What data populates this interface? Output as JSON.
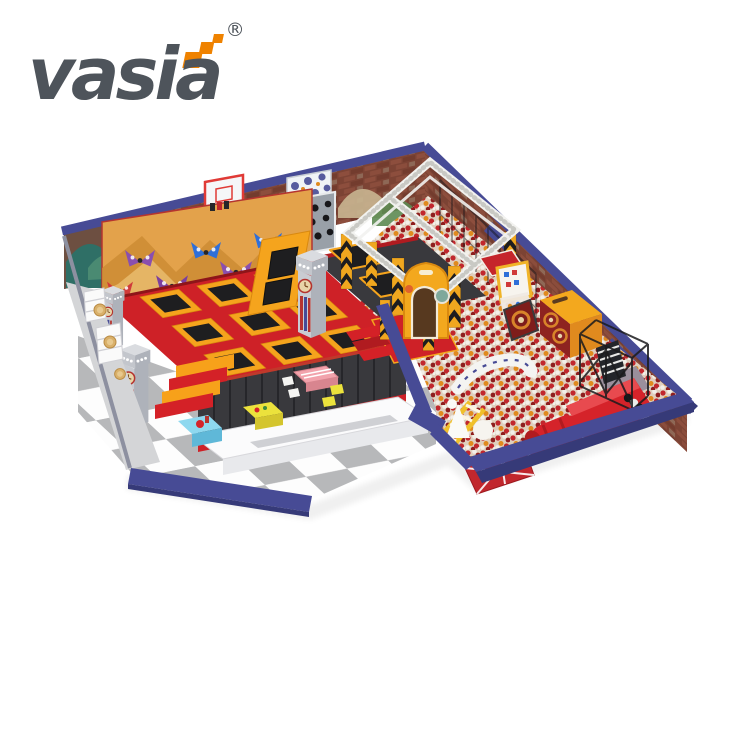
{
  "logo": {
    "brand": "vasia",
    "registered_mark": "®",
    "accent_squares_icon": "orange-steps-icon"
  },
  "palette": {
    "navy": "#474b95",
    "navyD": "#363a78",
    "brick": "#7c4334",
    "brickL": "#915140",
    "deckRed": "#ce2127",
    "deckRedD": "#9e1a1f",
    "frameYellow": "#f5a41d",
    "frameYellowD": "#d9890f",
    "bedBlack": "#1e1e20",
    "plat": "#39393d",
    "platD": "#242427",
    "mur": "#e3a24b",
    "murS": "#cd8c34",
    "murL": "#eec579",
    "tileGray": "#b7b8ba",
    "tileWhite": "#fdfdfd",
    "walk": "#d4d5d7",
    "truss": "#f2f2ef",
    "haz": "#f0a71f",
    "ballRed": "#c1272d",
    "ballDark": "#8e1e1e",
    "ballOrange": "#e08a1e",
    "ballCream": "#f3efe8",
    "pitBase": "#dfcfbd",
    "twrGray": "#c9ccd2",
    "twrShade": "#aeb2ba",
    "stripeRed": "#b5342f",
    "skyBlue": "#8ed8ef",
    "kidYellow": "#ece23c",
    "kidPink": "#f2a3ac",
    "arch": "#f3a81e",
    "cream": "#f7f4ee",
    "logoGray": "#4e545b",
    "logoOrange": "#ef8200"
  }
}
